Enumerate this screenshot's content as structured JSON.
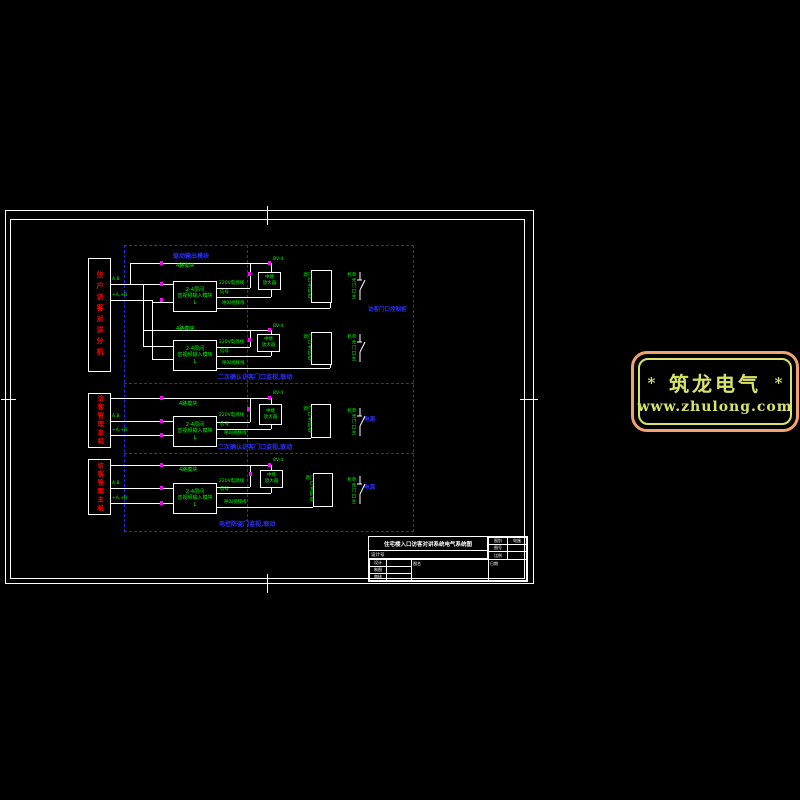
{
  "colors": {
    "background": "#000000",
    "line": "#FFFFFF",
    "red_text": "#FF0000",
    "green_text": "#00FF00",
    "blue": "#2424FF",
    "magenta_marker": "#FF00FF",
    "logo_border": "#F2A26E",
    "logo_text": "#D9E368"
  },
  "logo": {
    "star_left": "*",
    "brand": "筑龙电气",
    "star_right": "*",
    "url": "www.zhulong.com"
  },
  "diagram": {
    "module_label": "驱动输出模块",
    "sections": [
      {
        "red_block": "住户访客对讲分机",
        "section_label": "二次确认访客门口监视,联动",
        "right_label": "访客门口控制柜"
      },
      {
        "red_block": "访客管理主机",
        "section_label": "二次确认访客门口监视,联动",
        "right_label": "电源"
      },
      {
        "red_block": "访客管理主机",
        "section_label": "电控防盗门监视,联动",
        "right_label": "电源"
      }
    ],
    "unit_labels": {
      "above_box": "4路模块",
      "bigbox_lines": [
        "2-4层间",
        "音视频输入模块",
        "L"
      ],
      "smallbox_lines": [
        "中继",
        "放大器"
      ],
      "tallbox_label": "门口主机电源",
      "switch_label": "单元门口主机",
      "stub1": "A,B",
      "stub2": "+A,+B",
      "wire1": "220V电源线",
      "wire2": "信号",
      "wire3": "呼叫视频线",
      "feed": "BV-4"
    }
  },
  "title_block": {
    "title": "住宅楼入口访客对讲系统电气系统图",
    "type_label": "图别",
    "type_value": "电施",
    "no_label": "图号",
    "no_value": "",
    "scale_label": "比例",
    "scale_value": "",
    "project_label": "设计号",
    "rows": [
      {
        "label": "设计",
        "value": ""
      },
      {
        "label": "制图",
        "value": ""
      },
      {
        "label": "审核",
        "value": ""
      }
    ],
    "name_label": "图名",
    "date_label": "日期"
  }
}
